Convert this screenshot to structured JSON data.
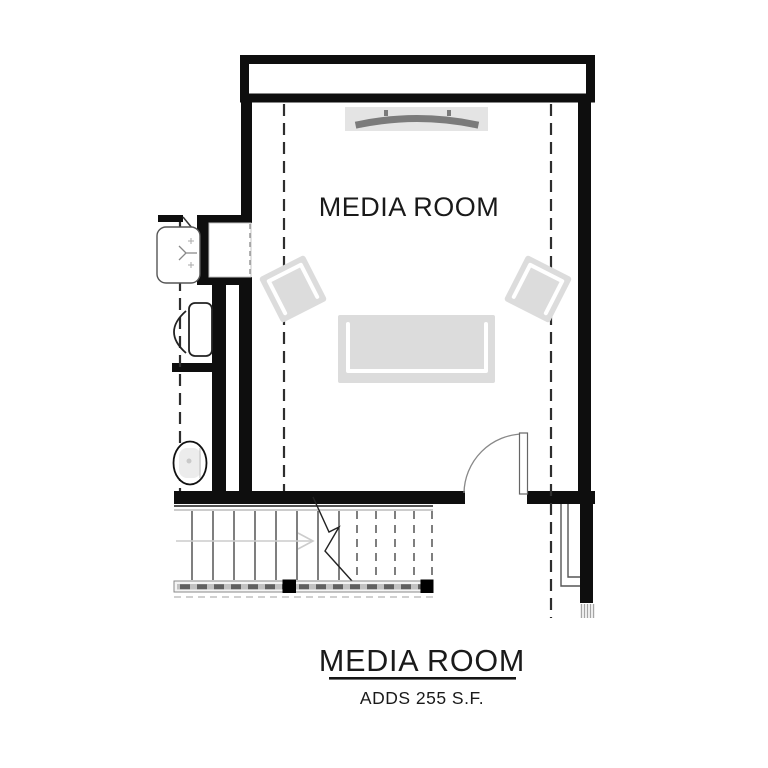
{
  "floor_plan": {
    "room_label": "MEDIA ROOM",
    "title_block": {
      "title": "MEDIA ROOM",
      "subtitle": "ADDS 255 S.F."
    },
    "colors": {
      "background": "#ffffff",
      "wall": "#0e0e0e",
      "furniture": "#dcdcdc",
      "tv": "#7b7b7b",
      "tv_backdrop": "#e4e4e4",
      "dashed": "#2e2e2e",
      "thin_line": "#555555",
      "stair_tread": "#3a3a3a",
      "arrow": "#cccccc",
      "rail": "#c2c2c2",
      "hatch": "#a5a5a5",
      "text": "#1a1a1a"
    },
    "symbols": [
      {
        "name": "tv-symbol"
      },
      {
        "name": "armchair-left-symbol"
      },
      {
        "name": "armchair-right-symbol"
      },
      {
        "name": "sofa-symbol"
      },
      {
        "name": "door-swing-symbol"
      },
      {
        "name": "stairs-symbol"
      },
      {
        "name": "stair-direction-arrow"
      },
      {
        "name": "stair-break-line"
      },
      {
        "name": "handrail-symbol"
      },
      {
        "name": "sink-symbol"
      },
      {
        "name": "toilet-symbol"
      },
      {
        "name": "water-closet-symbol"
      },
      {
        "name": "attic-knee-wall-dashed-lines"
      }
    ]
  }
}
